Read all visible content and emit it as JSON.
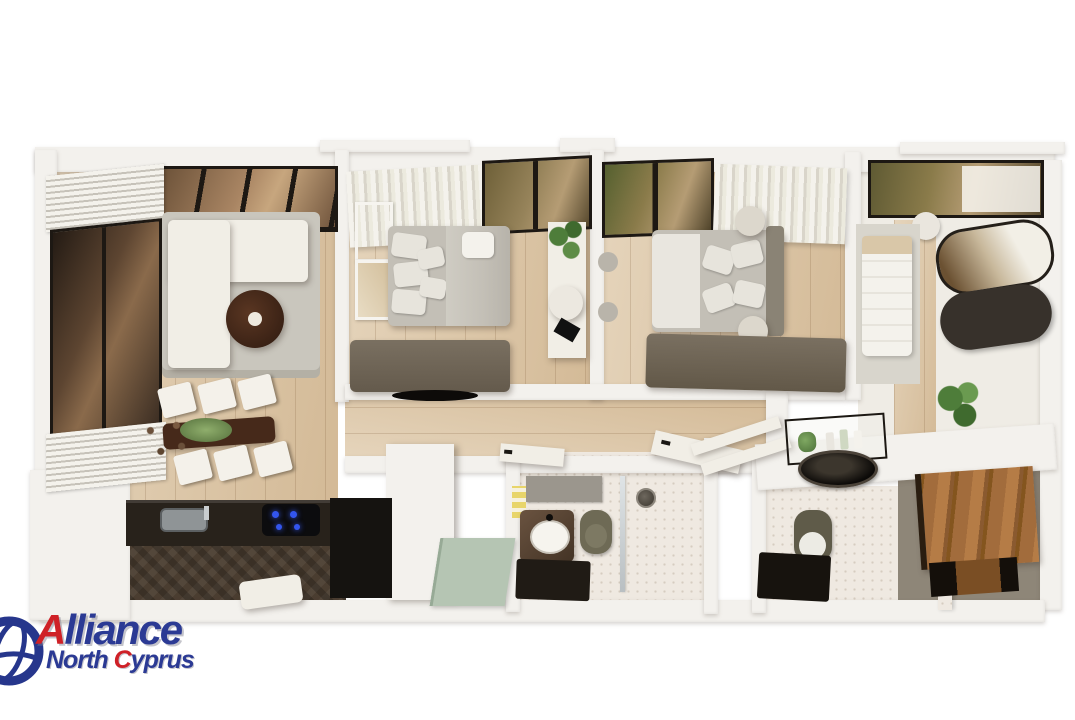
{
  "scene": {
    "type": "3d-apartment-floor-plan-render",
    "view": "top-down cutaway 3D render",
    "rooms": [
      "living-room",
      "kitchen",
      "dining-area",
      "bedroom-1",
      "bedroom-2",
      "bedroom-3-dressing",
      "hallway",
      "entrance",
      "bathroom-1",
      "bathroom-2-ensuite",
      "walk-in-closet"
    ],
    "furniture": [
      "l-shaped-sofa",
      "round-coffee-table",
      "area-rug",
      "dining-table",
      "dining-chairs",
      "kitchen-counter",
      "induction-hob",
      "kitchen-sink",
      "double-bed",
      "wall-art",
      "dresser-tv-unit",
      "vanity-desk",
      "wardrobe",
      "oval-mirror",
      "toilet",
      "shower",
      "wash-basin",
      "plants",
      "curtains",
      "panoramic-windows",
      "louver-blinds",
      "poufs",
      "entrance-mat"
    ]
  },
  "logo": {
    "icon": "globe-icon",
    "word1_initial": "A",
    "word1_rest": "lliance",
    "word2_part1": "North ",
    "word2_initial": "C",
    "word2_rest": "yprus"
  },
  "colors": {
    "bg": "#ffffff",
    "wall": "#f3f1ed",
    "wood": "#dcc5a3",
    "glassDark": "#3a2d23",
    "frame": "#1d1813",
    "rug": "#c9c6bd",
    "sofa": "#f1eee6",
    "tableWood": "#46291a",
    "bedGray": "#c3bfb6",
    "dresser": "#6f6455",
    "sage": "#b5c5b3",
    "marble": "#efe9e1",
    "parquet": "#4a3d30",
    "counter": "#28221b",
    "walnut": "#a26c3c",
    "taupeFloor": "#8e8678",
    "olive": "#6e6a55",
    "hobBlue": "#3355ee",
    "plant": "#4e7d3a",
    "logoBlue": "#2b3a94",
    "logoRed": "#cf2127"
  }
}
